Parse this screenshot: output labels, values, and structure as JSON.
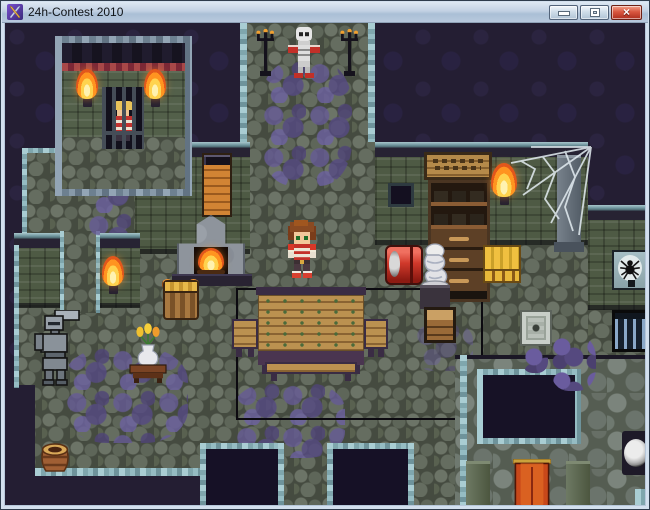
{
  "window": {
    "title": "24h-Contest 2010",
    "icon": "crossed-swords-rpg-maker-icon",
    "controls": {
      "minimize": "minimize",
      "maximize": "maximize",
      "close": "close",
      "close_glyph": "×"
    }
  },
  "colors": {
    "titlebar": "#bccde0",
    "close_button": "#c3402f",
    "void_background": "#241e33",
    "wall_green": "#53604a",
    "floor_gray": "#5f675a",
    "floor_purple_stones": "#5f5590",
    "trim_teal": "#7fa6ad",
    "flame_orange": "#ff9420",
    "banner_orange": "#c8481a",
    "table_wood": "#bb9150",
    "chimney_brick": "#d18434"
  },
  "scene": {
    "name": "dungeon-interior-map",
    "objects": [
      {
        "name": "jail-cell-room",
        "label": "Stone cell room with barred jail"
      },
      {
        "name": "prisoner",
        "label": "Prisoner behind bars"
      },
      {
        "name": "wall-torch",
        "label": "Burning wall torches (4)"
      },
      {
        "name": "skeleton-statue",
        "label": "Skeleton figure at top corridor"
      },
      {
        "name": "candelabra",
        "label": "Black candle stands (2)"
      },
      {
        "name": "fireplace",
        "label": "Stone fireplace with brick chimney and fire"
      },
      {
        "name": "hero",
        "label": "Red-armored hero with brown hair"
      },
      {
        "name": "dining-table",
        "label": "Large wooden table with benches"
      },
      {
        "name": "black-floor-marking",
        "label": "Black rectangle outline on floor"
      },
      {
        "name": "armor-statue",
        "label": "Suit of armor"
      },
      {
        "name": "flower-vase-table",
        "label": "Small table with flower vase"
      },
      {
        "name": "storage-basket",
        "label": "Basket barrel with grain"
      },
      {
        "name": "clay-pot",
        "label": "Clay pot at bottom-left"
      },
      {
        "name": "red-barrel",
        "label": "Red barrel"
      },
      {
        "name": "mummy-statue",
        "label": "White mummy statue on pedestal"
      },
      {
        "name": "wooden-crate",
        "label": "Wooden crate"
      },
      {
        "name": "gold-crate",
        "label": "Golden slatted crate"
      },
      {
        "name": "shelf-cabinet",
        "label": "Tall shelf cabinet with drawers"
      },
      {
        "name": "wall-window",
        "label": "Small dark wall window"
      },
      {
        "name": "spider-web",
        "label": "Spider web on pillar"
      },
      {
        "name": "spider-emblem-shield",
        "label": "Spider emblem plaque"
      },
      {
        "name": "floor-grate",
        "label": "Barred floor grate"
      },
      {
        "name": "decorative-floor-tile",
        "label": "Ornate pale floor tile"
      },
      {
        "name": "round-shield",
        "label": "Round shield on stone wall"
      },
      {
        "name": "wall-banner",
        "label": "Orange hanging banner over dark doorway"
      },
      {
        "name": "floor-pit",
        "label": "Dark floor openings (2)"
      },
      {
        "name": "rubble",
        "label": "Purple rubble piles"
      }
    ]
  }
}
